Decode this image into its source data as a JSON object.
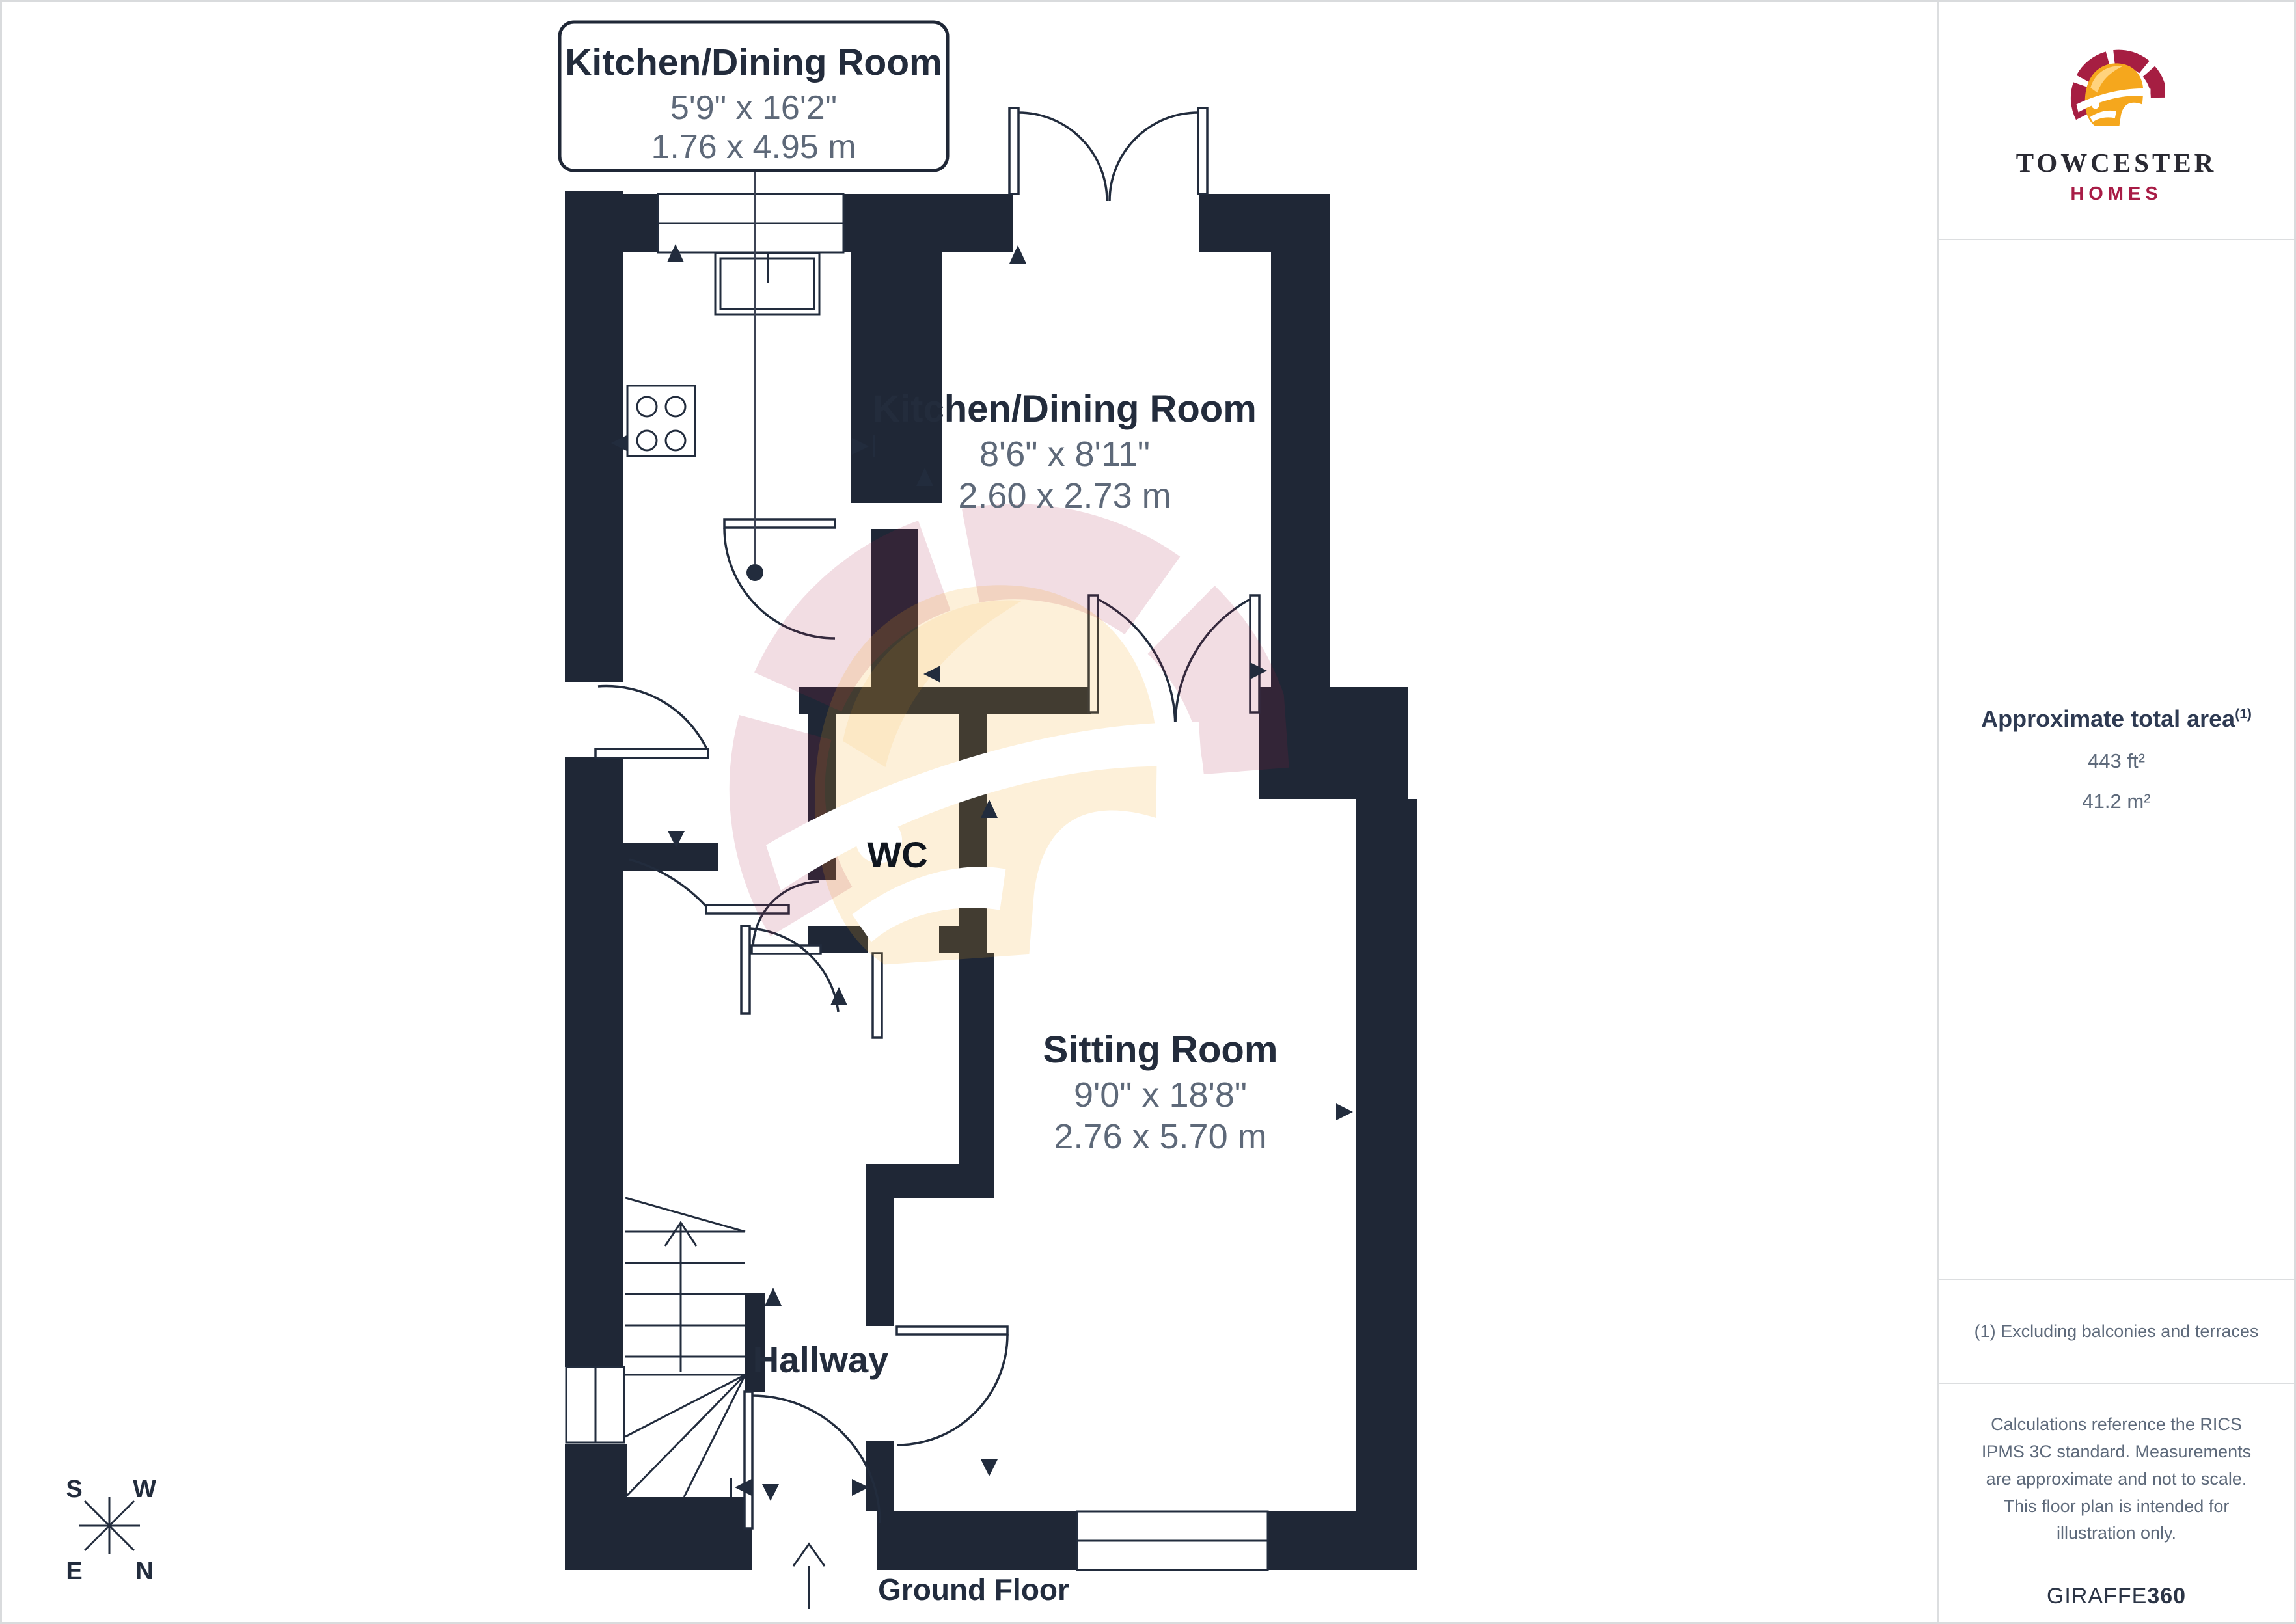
{
  "plan": {
    "callout": {
      "title": "Kitchen/Dining Room",
      "imperial": "5'9\" x 16'2\"",
      "metric": "1.76 x 4.95 m"
    },
    "rooms": {
      "kitchen_dining": {
        "name": "Kitchen/Dining Room",
        "imperial": "8'6\" x 8'11\"",
        "metric": "2.60 x 2.73 m"
      },
      "sitting": {
        "name": "Sitting Room",
        "imperial": "9'0\" x 18'8\"",
        "metric": "2.76 x 5.70 m"
      },
      "wc": {
        "name": "WC"
      },
      "hallway": {
        "name": "Hallway"
      }
    },
    "floor_label": "Ground Floor",
    "compass": {
      "s": "S",
      "w": "W",
      "e": "E",
      "n": "N"
    }
  },
  "sidebar": {
    "brand": {
      "name": "TOWCESTER",
      "tagline": "HOMES"
    },
    "area": {
      "title": "Approximate total area",
      "sup": "(1)",
      "imperial": "443 ft²",
      "metric": "41.2 m²"
    },
    "footnote": "(1) Excluding balconies and terraces",
    "disclaimer": "Calculations reference the RICS IPMS 3C standard. Measurements are approximate and not to scale. This floor plan is intended for illustration only.",
    "credit": {
      "brand": "GIRAFFE",
      "suffix": "360"
    }
  },
  "colors": {
    "wall": "#1f2736",
    "label_text": "#232c3c",
    "dim_text": "#5e6979",
    "accent_crimson": "#a61e42",
    "accent_gold": "#f5a71d",
    "divider": "#d9dbdd"
  }
}
